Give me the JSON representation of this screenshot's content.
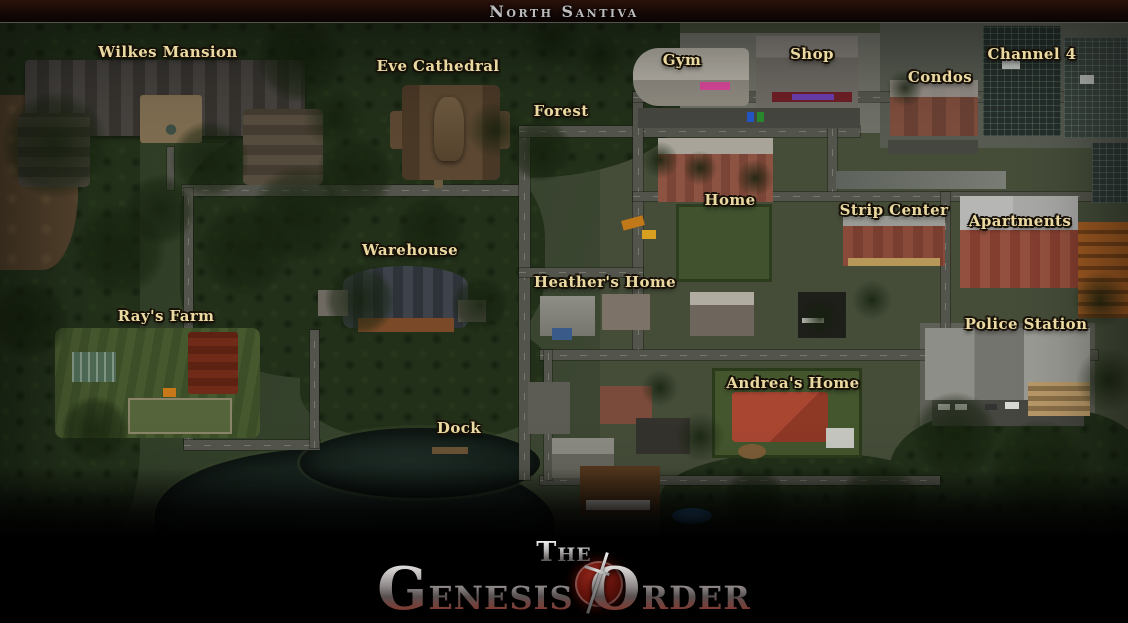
{
  "header": {
    "title": "North Santiva"
  },
  "map": {
    "labels": [
      {
        "id": "wilkes-mansion",
        "text": "Wilkes Mansion"
      },
      {
        "id": "eve-cathedral",
        "text": "Eve Cathedral"
      },
      {
        "id": "forest",
        "text": "Forest"
      },
      {
        "id": "gym",
        "text": "Gym"
      },
      {
        "id": "shop",
        "text": "Shop"
      },
      {
        "id": "condos",
        "text": "Condos"
      },
      {
        "id": "channel-4",
        "text": "Channel 4"
      },
      {
        "id": "home",
        "text": "Home"
      },
      {
        "id": "strip-center",
        "text": "Strip Center"
      },
      {
        "id": "apartments",
        "text": "Apartments"
      },
      {
        "id": "warehouse",
        "text": "Warehouse"
      },
      {
        "id": "heathers-home",
        "text": "Heather's Home"
      },
      {
        "id": "rays-farm",
        "text": "Ray's Farm"
      },
      {
        "id": "police-station",
        "text": "Police Station"
      },
      {
        "id": "andreas-home",
        "text": "Andrea's Home"
      },
      {
        "id": "dock",
        "text": "Dock"
      }
    ]
  },
  "footer": {
    "logo": {
      "word1": "The",
      "word2": "Genesis",
      "word3": "Order"
    },
    "website": "NLT-MEDIA.COM"
  },
  "colors": {
    "label-color": "#ead9a0",
    "logo-red": "#92261a",
    "title-color": "#bdbdbd"
  }
}
